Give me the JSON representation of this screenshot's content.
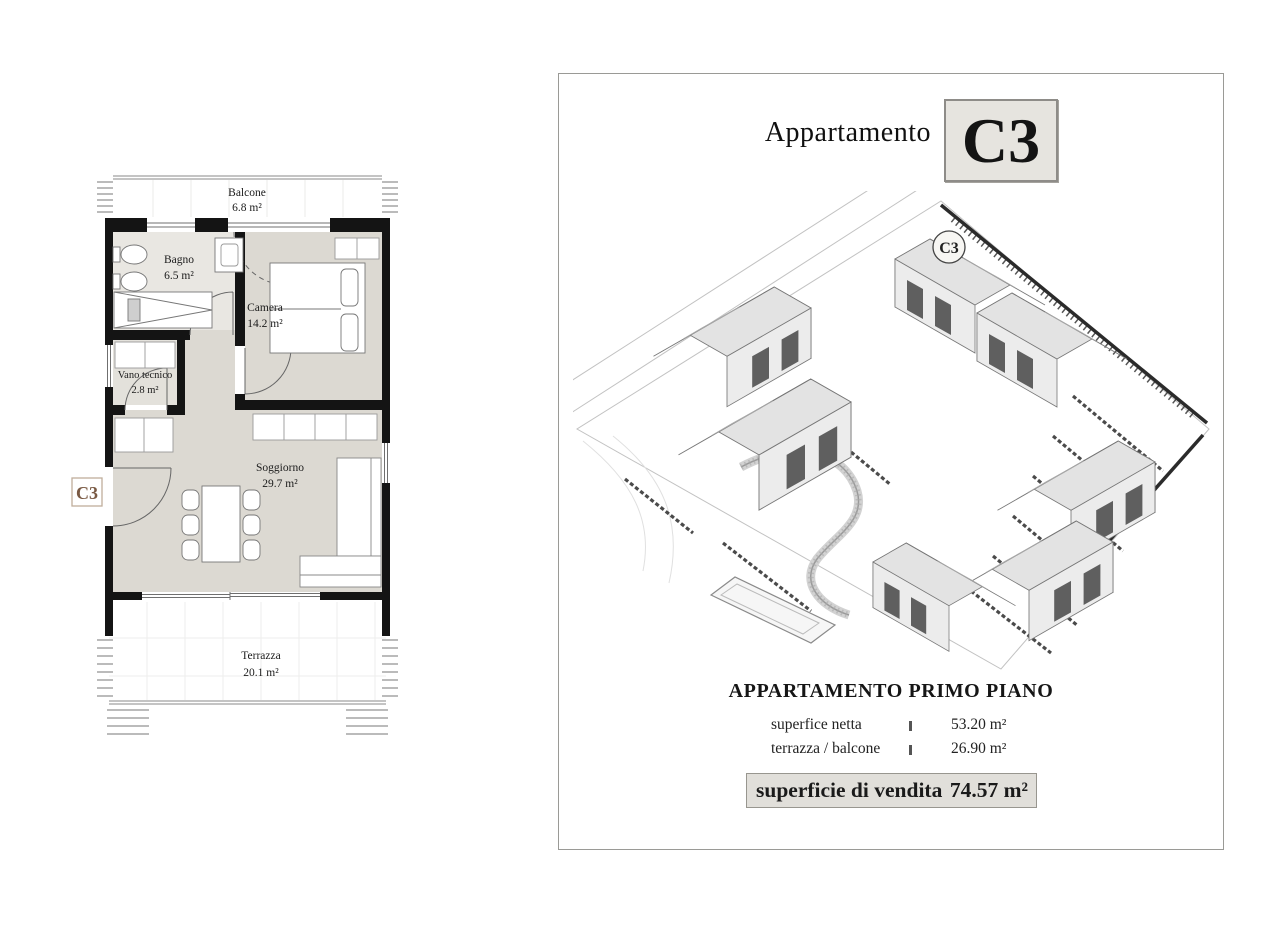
{
  "floor_plan": {
    "unit_label": "C3",
    "rooms": {
      "balcone": {
        "name": "Balcone",
        "area": "6.8 m²"
      },
      "bagno": {
        "name": "Bagno",
        "area": "6.5 m²"
      },
      "camera": {
        "name": "Camera",
        "area": "14.2 m²"
      },
      "vano_tecnico": {
        "name": "Vano tecnico",
        "area": "2.8 m²"
      },
      "soggiorno": {
        "name": "Soggiorno",
        "area": "29.7 m²"
      },
      "terrazza": {
        "name": "Terrazza",
        "area": "20.1 m²"
      }
    }
  },
  "panel": {
    "title": "Appartamento",
    "unit_code": "C3",
    "site_plan": {
      "badge": "C3"
    },
    "summary": {
      "heading": "APPARTAMENTO PRIMO PIANO",
      "rows": [
        {
          "label": "superfice netta",
          "value": "53.20 m²"
        },
        {
          "label": "terrazza / balcone",
          "value": "26.90 m²"
        }
      ],
      "total_label": "superficie di vendita",
      "total_value": "74.57 m²"
    }
  },
  "colors": {
    "wall": "#141414",
    "floor_gray": "#dcd9d2",
    "bagno_floor": "#e9e7e2",
    "accent_brown": "#7a5a44",
    "box_gray": "#e1dfda",
    "panel_border": "#9a9a96"
  }
}
